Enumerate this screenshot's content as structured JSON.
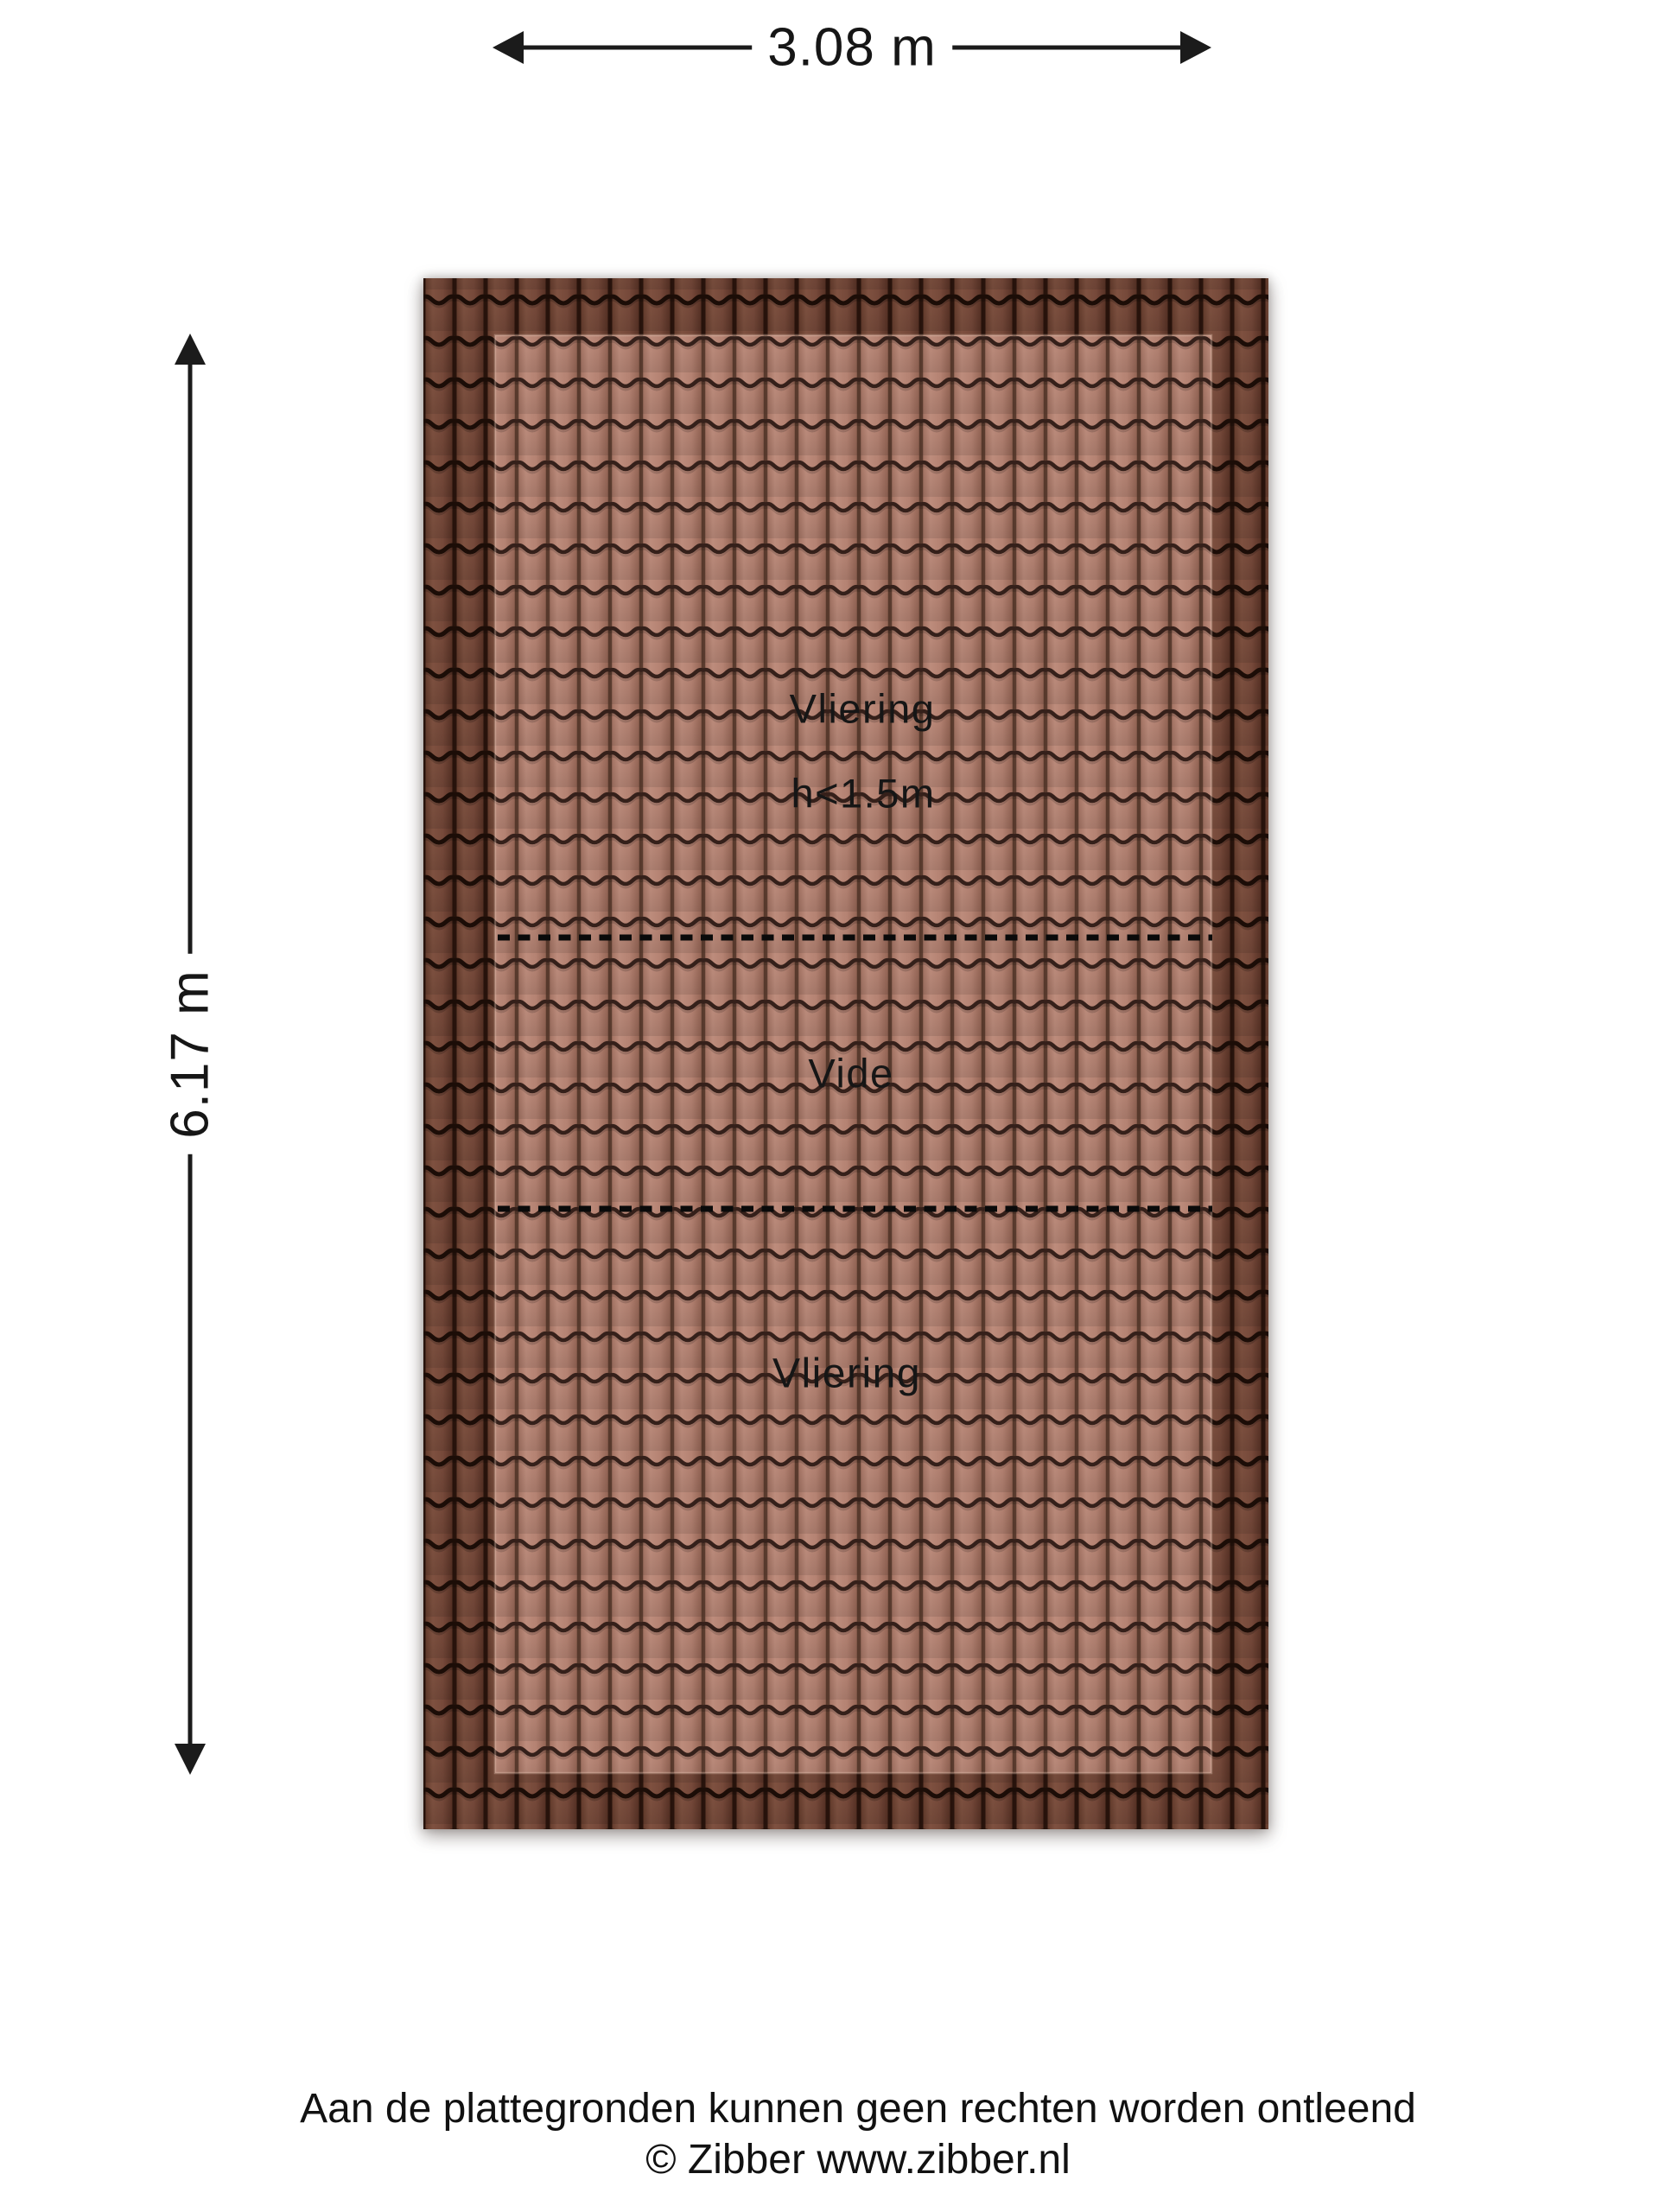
{
  "plan": {
    "type": "roof-floorplan",
    "dimensions": {
      "width_label": "3.08 m",
      "height_label": "6.17 m"
    },
    "areas": {
      "top": {
        "label": "Vliering",
        "sublabel": "h<1.5m"
      },
      "middle": {
        "label": "Vide"
      },
      "bottom": {
        "label": "Vliering"
      }
    }
  },
  "footer": {
    "disclaimer": "Aan de plattegronden kunnen geen rechten worden ontleend",
    "copyright": "© Zibber www.zibber.nl"
  },
  "colors": {
    "background": "#ffffff",
    "roof_border_tile": "#6e4334",
    "roof_inner_tile": "#b28070",
    "tile_line_border": "#1c0d07",
    "tile_line_inner": "#35201a",
    "dimension_line": "#1b1b1b",
    "dashed_divider": "#0a0a0a",
    "text": "#161616"
  }
}
